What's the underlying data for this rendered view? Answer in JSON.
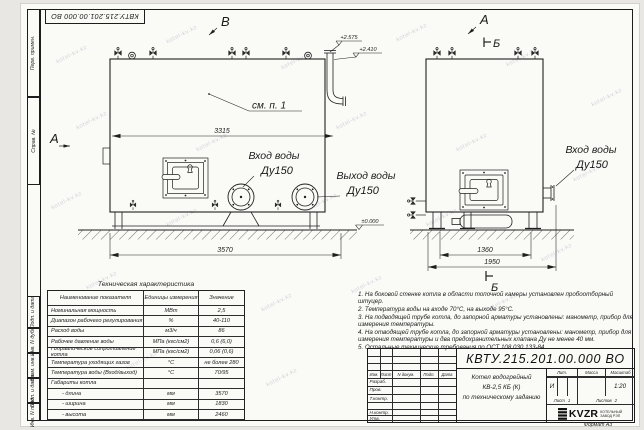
{
  "stamp_top": "КВТУ.215.201.00.000 ВО",
  "watermark": "kotel-kv.kz",
  "margin_labels": [
    "Перв. примен.",
    "Справ. №",
    "Подп. и дата",
    "Инв. N дубл.",
    "Взам. инв. N",
    "Подп. и дата",
    "Инв. N подл."
  ],
  "drawing": {
    "view_b_label": "В",
    "view_a_front": "А",
    "side_a_label": "А",
    "section_b_top": "Б",
    "section_b_bottom": "Б",
    "see_note": "см. п. 1",
    "dim_3315": "3315",
    "dim_3570": "3570",
    "dim_1360": "1360",
    "dim_1950": "1950",
    "elev_top1": "+2.575",
    "elev_top2": "+2.410",
    "elev_zero": "±0.000",
    "inlet_front_l1": "Вход воды",
    "inlet_front_l2": "Ду150",
    "outlet_front_l1": "Выход воды",
    "outlet_front_l2": "Ду150",
    "inlet_side_l1": "Вход воды",
    "inlet_side_l2": "Ду150"
  },
  "table": {
    "title": "Техническая характеристика",
    "headers": [
      "Наименование показателя",
      "Единицы измерения",
      "Значение"
    ],
    "rows": [
      [
        "Номинальная мощность",
        "МВт",
        "2,5"
      ],
      [
        "Диапазон рабочего регулирования",
        "%",
        "40-110"
      ],
      [
        "Расход воды",
        "м3/ч",
        "86"
      ],
      [
        "Рабочее давление воды",
        "МПа (кгс/см2)",
        "0,6 (6,0)"
      ],
      [
        "Гидравлическое сопротивление котла",
        "МПа (кгс/см2)",
        "0,06 (0,6)"
      ],
      [
        "Температура уходящих газов",
        "°С",
        "не более 280"
      ],
      [
        "Температура воды (Вход/выход)",
        "°С",
        "70/95"
      ],
      [
        "Габариты котла",
        "",
        ""
      ],
      [
        "- длина",
        "мм",
        "3570"
      ],
      [
        "- ширина",
        "мм",
        "1830"
      ],
      [
        "- высота",
        "мм",
        "2460"
      ]
    ]
  },
  "notes": [
    "1.  На боковой стенке котла в области топочной камеры установлен пробоотборный штуцер.",
    "2.  Температура воды на входе 70°С, на выходе 95°С.",
    "3.  На подводящей трубе котла, до запорной арматуры установлены: манометр, прибор для измерения температуры.",
    "4.  На отводящей трубе котла, до запорной арматуры установлены: манометр, прибор для измерения температуры и два предохранительных клапана  Ду не менее 40 мм.",
    "5.  Остальные технические требования по ОСТ 108.030.133-84."
  ],
  "title_block": {
    "doc_number": "КВТУ.215.201.00.000  ВО",
    "name_line1": "Котел водогрейный",
    "name_line2": "КВ-2,5 КБ (К)",
    "name_line3": "по техническому заданию",
    "col_headers": [
      "Изм.",
      "Лист",
      "N докум.",
      "Подп.",
      "Дата"
    ],
    "sign_labels": [
      "Разраб.",
      "Пров.",
      "Т.контр.",
      "Н.контр.",
      "Утв."
    ],
    "lit_header": "Лит.",
    "mass_header": "Масса",
    "scale_header": "Масштаб",
    "lit_value": "И",
    "scale_value": "1:20",
    "sheet_label": "Лист",
    "sheet_value": "1",
    "sheets_label": "Листов",
    "sheets_value": "2",
    "logo_text": "KVZR",
    "logo_sub1": "КОТЕЛЬНЫЙ",
    "logo_sub2": "ЗАВОД РЭП",
    "format_label": "Формат  А3"
  }
}
